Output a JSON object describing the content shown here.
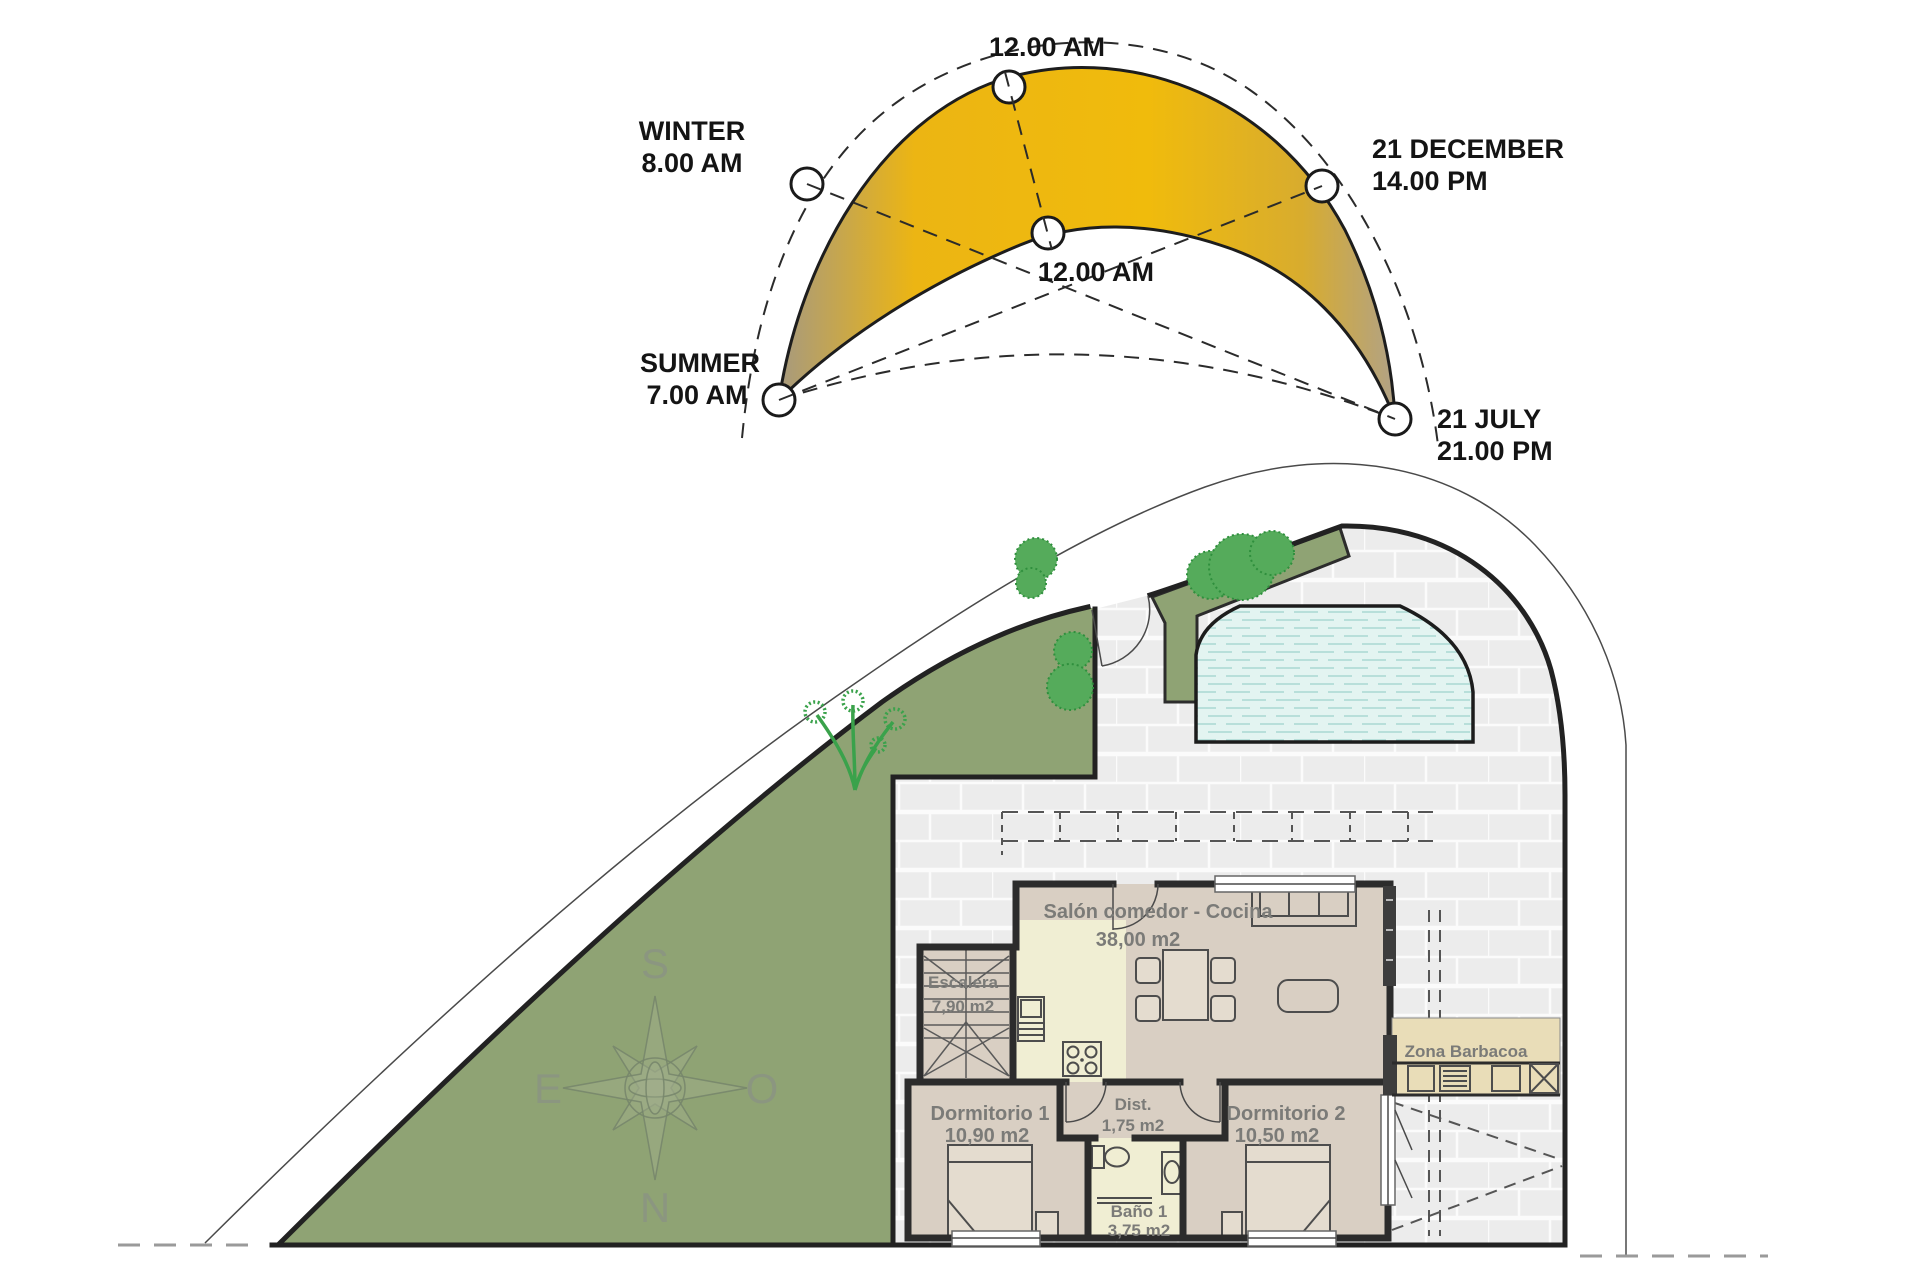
{
  "sun_diagram": {
    "top_label": "12.00 AM",
    "noon_label": "12.00 AM",
    "winter": {
      "line1": "WINTER",
      "line2": "8.00 AM"
    },
    "december": {
      "line1": "21 DECEMBER",
      "line2": "14.00 PM"
    },
    "summer": {
      "line1": "SUMMER",
      "line2": "7.00 AM"
    },
    "july": {
      "line1": "21 JULY",
      "line2": "21.00 PM"
    },
    "colors": {
      "gold": "#eeb70f",
      "tip_gray": "#a99b7d"
    }
  },
  "floor_plan": {
    "compass": {
      "south": "S",
      "east": "E",
      "west": "O",
      "north": "N"
    },
    "rooms": {
      "salon": {
        "name": "Salón comedor - Cocina",
        "area": "38,00 m2"
      },
      "escalera": {
        "name": "Escalera",
        "area": "7,90 m2"
      },
      "dormitorio1": {
        "name": "Dormitorio 1",
        "area": "10,90 m2"
      },
      "dist": {
        "name": "Dist.",
        "area": "1,75 m2"
      },
      "dormitorio2": {
        "name": "Dormitorio 2",
        "area": "10,50 m2"
      },
      "bano": {
        "name": "Baño 1",
        "area": "3,75 m2"
      },
      "barbacoa": {
        "name": "Zona Barbacoa"
      }
    },
    "colors": {
      "garden": "#8fa374",
      "bush": "#55ab5b",
      "pool_water": "#e3f4f1",
      "patio_brick": "#ececec",
      "room_floor": "#d9cfc3",
      "wet_room": "#f0eed3",
      "barbecue_area": "#e9ddb8",
      "wall": "#2c2c2c"
    }
  }
}
